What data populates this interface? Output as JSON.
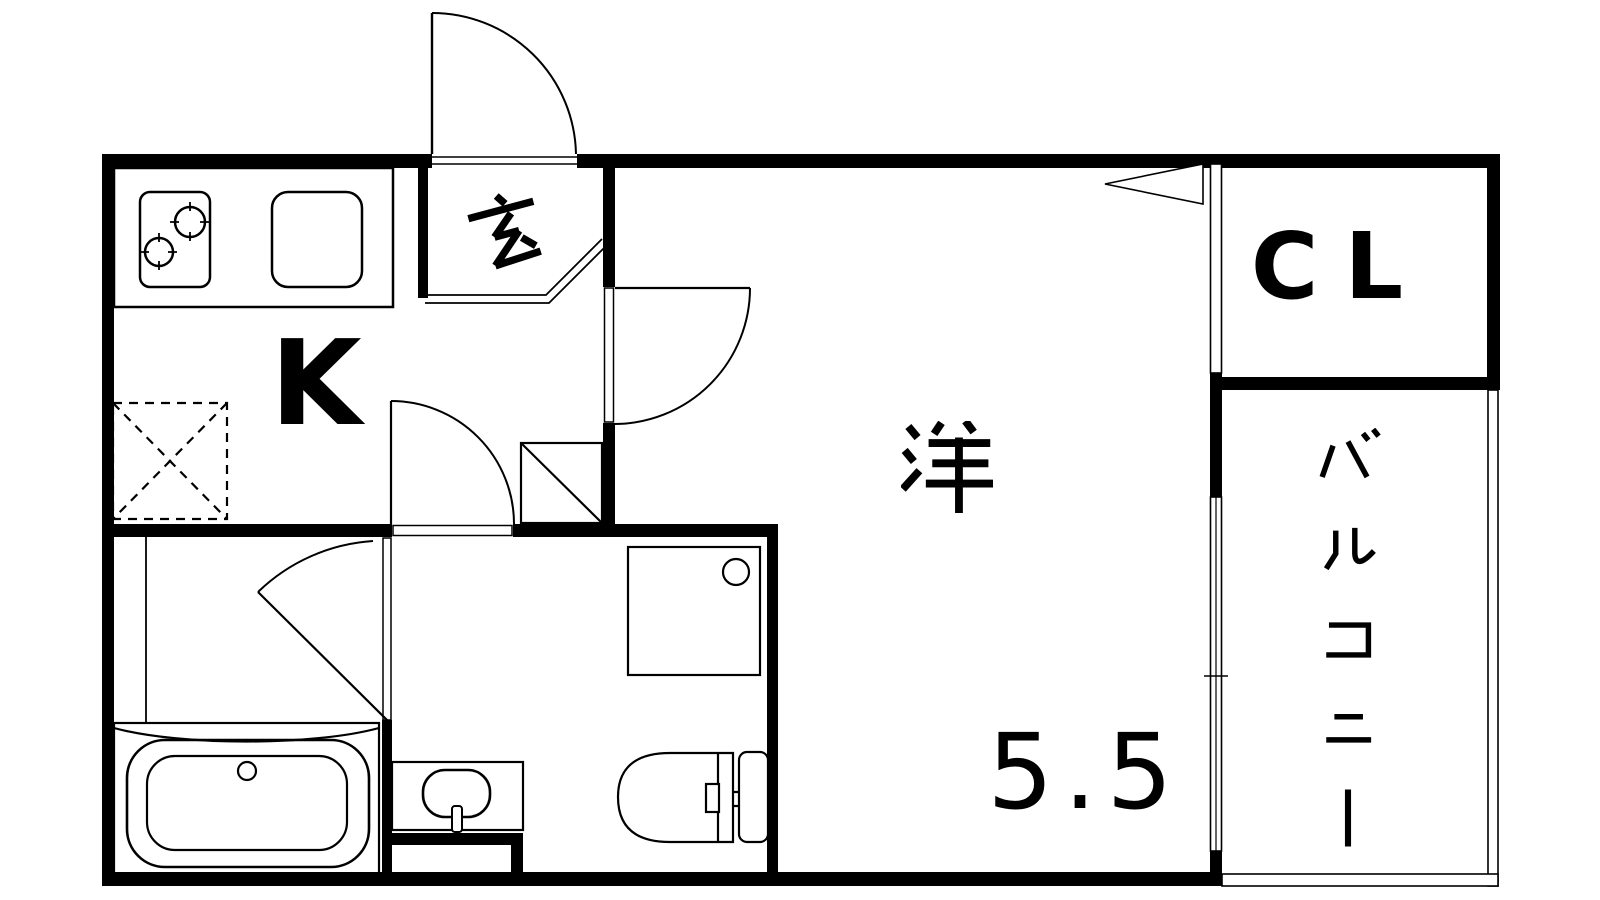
{
  "meta": {
    "type": "floor-plan",
    "style": "black-and-white line drawing"
  },
  "colors": {
    "ink": "#000000",
    "background": "#ffffff"
  },
  "plan": {
    "kitchen": {
      "label": "K"
    },
    "entrance": {
      "label": "玄"
    },
    "western_room": {
      "label": "洋",
      "tatami": "5.5"
    },
    "closet": {
      "label": "CL"
    },
    "balcony": {
      "label": "バルコニー"
    },
    "fixtures": [
      "stove-2-burner",
      "kitchen-sink",
      "refrigerator-space",
      "bathtub",
      "washbasin",
      "washing-machine-pan",
      "toilet",
      "hinged-doors",
      "folding-closet-door",
      "sliding-window"
    ]
  }
}
